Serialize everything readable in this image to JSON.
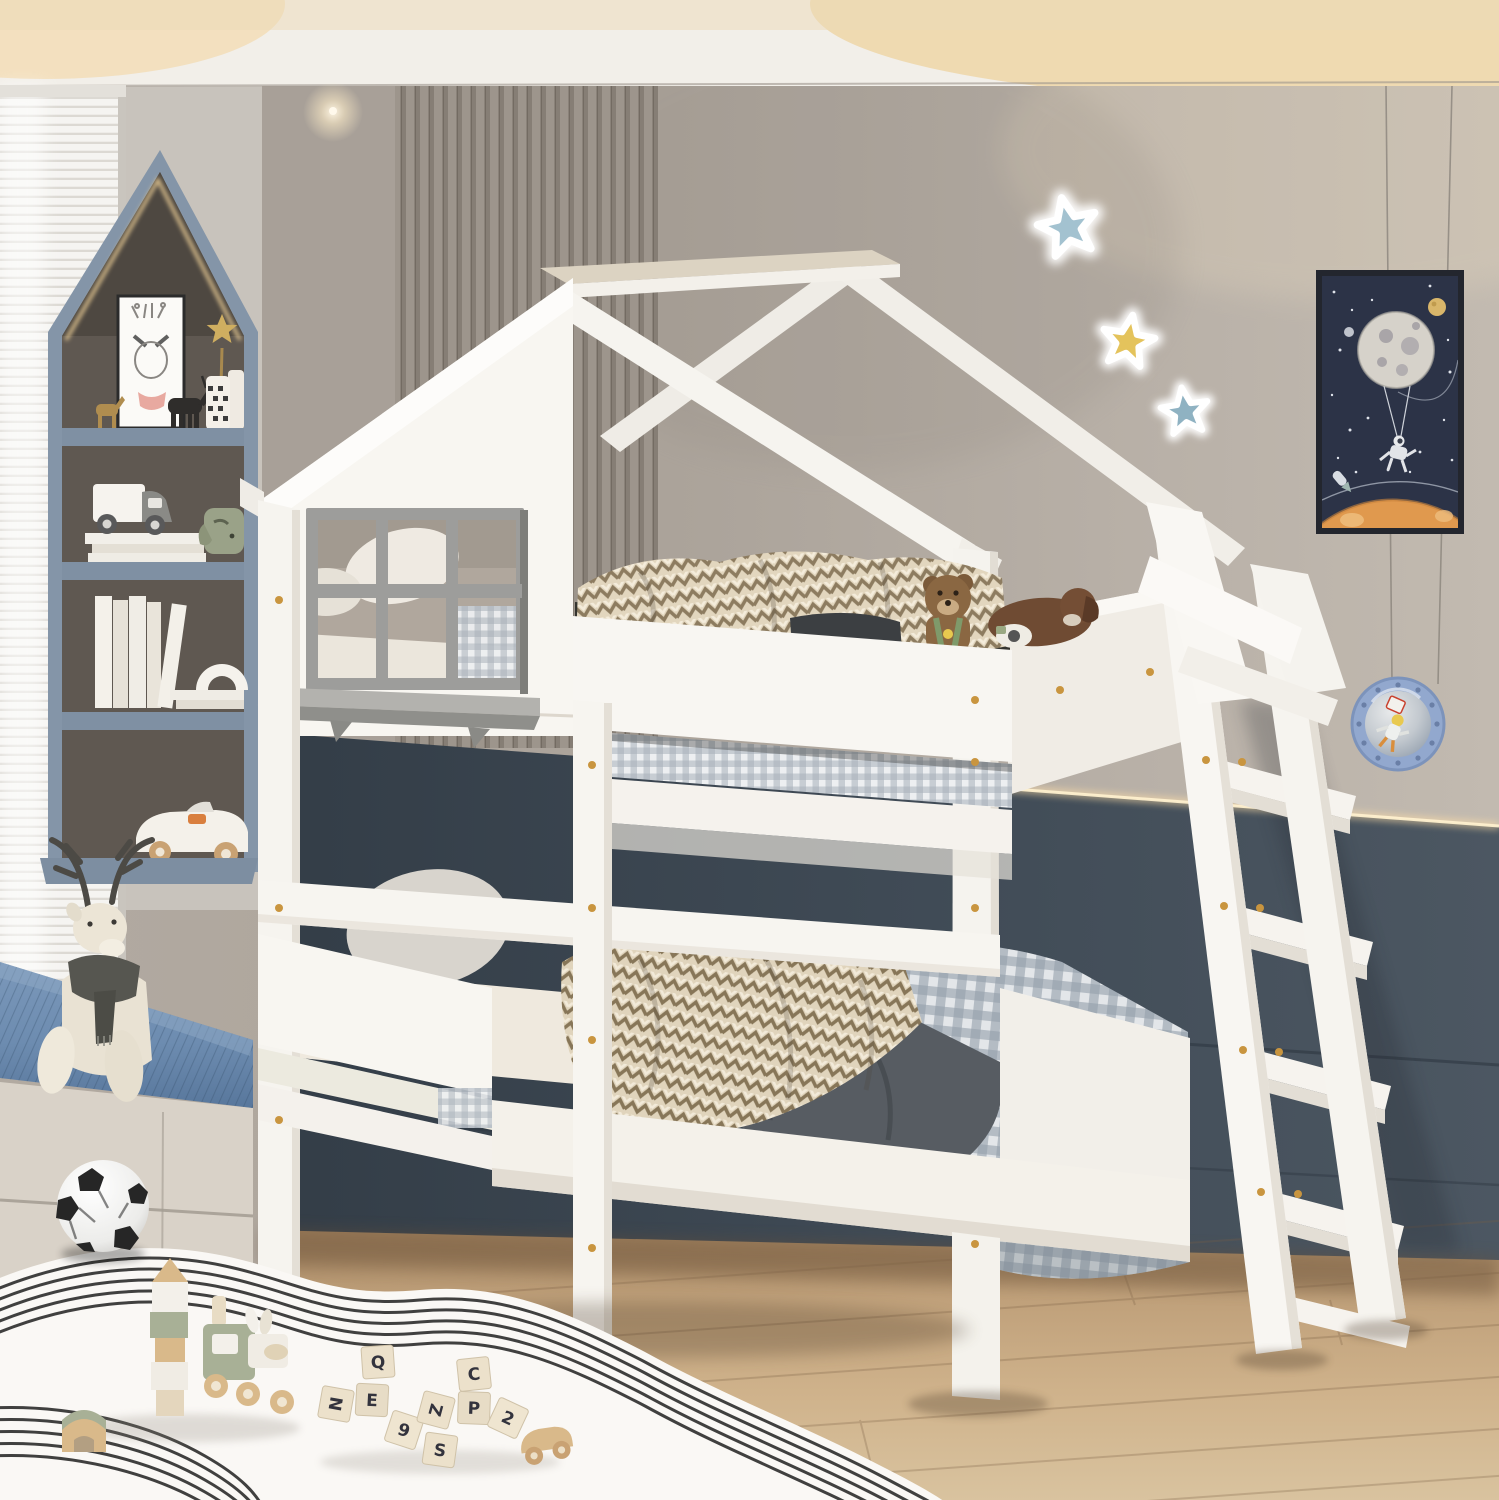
{
  "meta": {
    "description": "Product lifestyle photo: white house-frame twin-over-twin kids bunk bed with roof beams, six-pane gray window cutout, angled ladder, in a gray kids bedroom with house-shaped shelf niche, window bench, toys and space decor"
  },
  "bed": {
    "style": "house-frame bunk bed",
    "color": "white",
    "window_panes": 6,
    "ladder_steps": 5
  },
  "toy_blocks": {
    "letters": [
      "Q",
      "E",
      "N",
      "9",
      "S",
      "C",
      "P",
      "Z",
      "2"
    ]
  },
  "stars": [
    {
      "name": "star-blue-top",
      "color": "#a3c2d0"
    },
    {
      "name": "star-yellow-middle",
      "color": "#e4c35c"
    },
    {
      "name": "star-blue-bottom",
      "color": "#8fb2c2"
    }
  ],
  "poster": {
    "theme": "astronaut hanging from moon balloon",
    "background": "#2c3347",
    "planet": "#e0994e"
  },
  "palette": {
    "wall": "#b1a9a0",
    "wainscot": "#414c57",
    "floor_wood": "#ccb08a",
    "bed_white": "#f7f5f1",
    "window_frame_gray": "#9d9d9b",
    "bench_cushion_blue": "#6d8cb0",
    "shelf_niche_blue_gray": "#8495a8",
    "led_glow": "#ffdfa8",
    "screw_gold": "#c9953f",
    "plaid_bedding": "#a7b0ba",
    "blanket_tan": "#8d7c60",
    "duvet_gray": "#575c62"
  }
}
